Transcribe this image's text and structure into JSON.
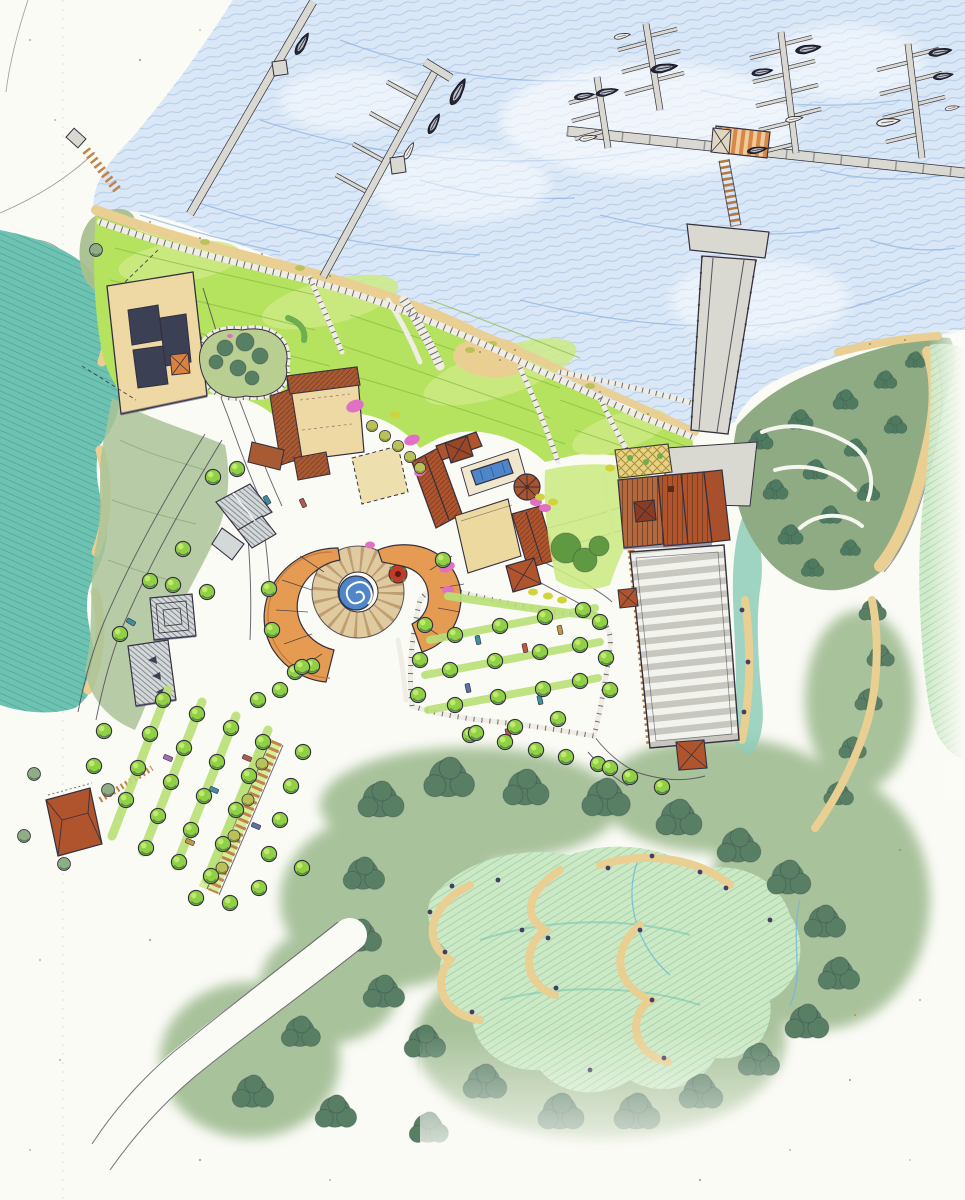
{
  "scene": {
    "medium_colors": {
      "paper": "#fbfbf6",
      "ink": "#34303e",
      "sea": "#d9e7f6",
      "sea_stroke": "#8fb2e0",
      "estuary": "#6fc2b2",
      "lagoon": "#cde8c4",
      "sand": "#e9cf92",
      "grass": "#b5e25f",
      "grass_light": "#cdea86",
      "sage": "#a4bd95",
      "forest": "#587f64",
      "stone": "#efede4",
      "dock": "#d9d9d2",
      "roof_red": "#b0542e",
      "roof_brown": "#a85b33",
      "tan": "#eed9a4",
      "plaza_orange": "#e59b52",
      "pool_blue": "#4f86c9",
      "flower_pink": "#e070c4",
      "flower_red": "#c23b2a",
      "boardwalk_wood": "#c08448",
      "trellis": "#e6d27f",
      "gray_roof": "#d3d8d8",
      "tree": "#8fd045",
      "tree_dark": "#3f6b4a",
      "olive": "#b9c258"
    },
    "inventory": {
      "marina_docks": 4,
      "breakwater_docks": 1,
      "long_piers": 2,
      "ferry_landing_floats": 1,
      "boats": 17,
      "buildings": 12,
      "pavilions": 4,
      "parking_lots": 2,
      "tree_allee": 1,
      "spiral_fountains": 1,
      "swimming_pools": 1,
      "trellis_courts": 2,
      "lagoons": 3
    }
  }
}
